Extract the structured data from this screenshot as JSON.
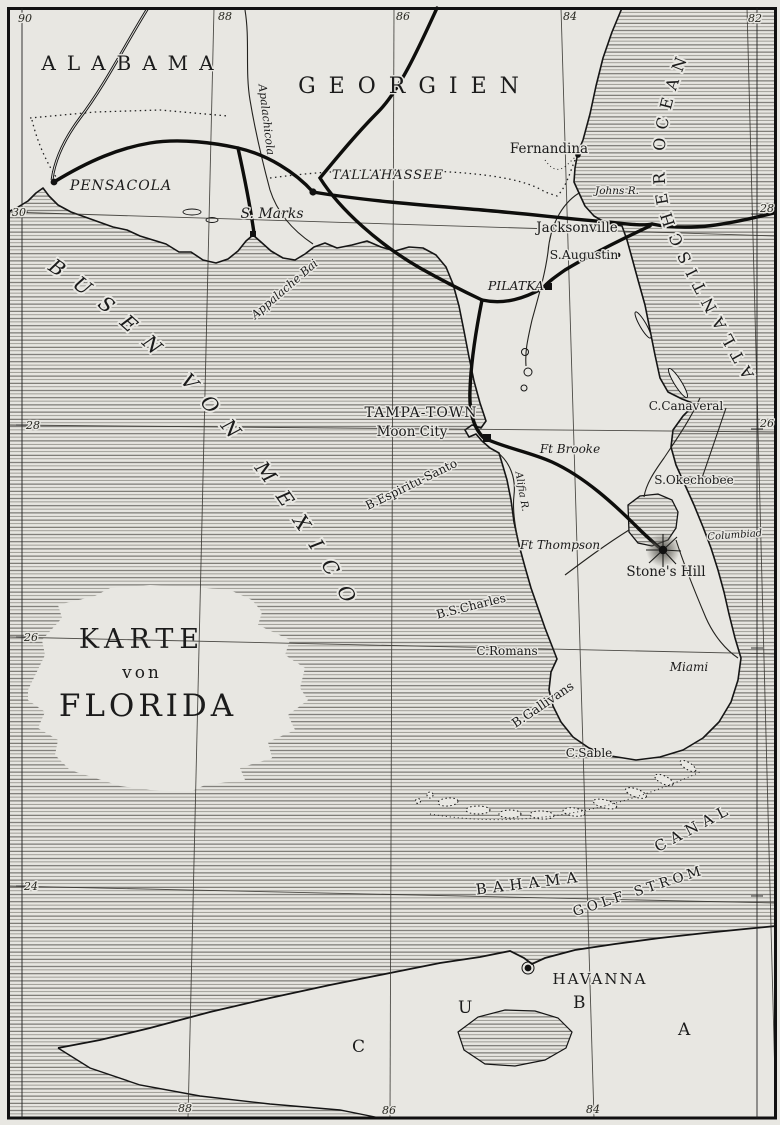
{
  "map_title": {
    "karte": "KARTE",
    "von": "von",
    "florida": "FLORIDA"
  },
  "regions": {
    "alabama": "ALABAMA",
    "georgien": "GEORGIEN",
    "cuba": [
      "C",
      "U",
      "B",
      "A"
    ]
  },
  "seas": {
    "gulf": "BUSEN VON MEXICO",
    "atlantic": "ATLANTISCHER OCEAN",
    "bahama": "BAHAMA",
    "canal": "CANAL",
    "golf_strom": "GOLF STROM"
  },
  "towns": {
    "pensacola": "PENSACOLA",
    "tallahassee": "TALLAHASSEE",
    "st_marks": "S. Marks",
    "fernandina": "Fernandina",
    "jacksonville": "Jacksonville",
    "st_augustin": "S.Augustin",
    "pilatka": "PILATKA",
    "tampa_town": "TAMPA-TOWN",
    "moon_city": "Moon City",
    "miami": "Miami",
    "havanna": "HAVANNA"
  },
  "forts": {
    "brooke": "Ft Brooke",
    "thompson": "Ft Thompson"
  },
  "capes": {
    "canaveral": "C.Canaveral",
    "romans": "C.Romans",
    "sable": "C.Sable"
  },
  "water": {
    "apalachicola": "Apalachicola",
    "appalache_bai": "Appalache Bai",
    "johns_r": "Johns R.",
    "alifia": "Alifia R.",
    "espiritu": "B.Espiritu-Santo",
    "st_charles": "B.S.Charles",
    "gallivans": "B.Gallivans",
    "okechobee": "S.Okechobee"
  },
  "landmarks": {
    "stones_hill": "Stone's Hill",
    "columbiad": "Columbiad"
  },
  "graticule": {
    "top": [
      "90",
      "88",
      "86",
      "84",
      "82"
    ],
    "bottom": [
      "88",
      "86",
      "84"
    ],
    "left": [
      "30",
      "28",
      "26",
      "24"
    ],
    "right": [
      "28",
      "26"
    ]
  },
  "colors": {
    "paper": "#e8e7e2",
    "ink": "#1b1b1b"
  }
}
